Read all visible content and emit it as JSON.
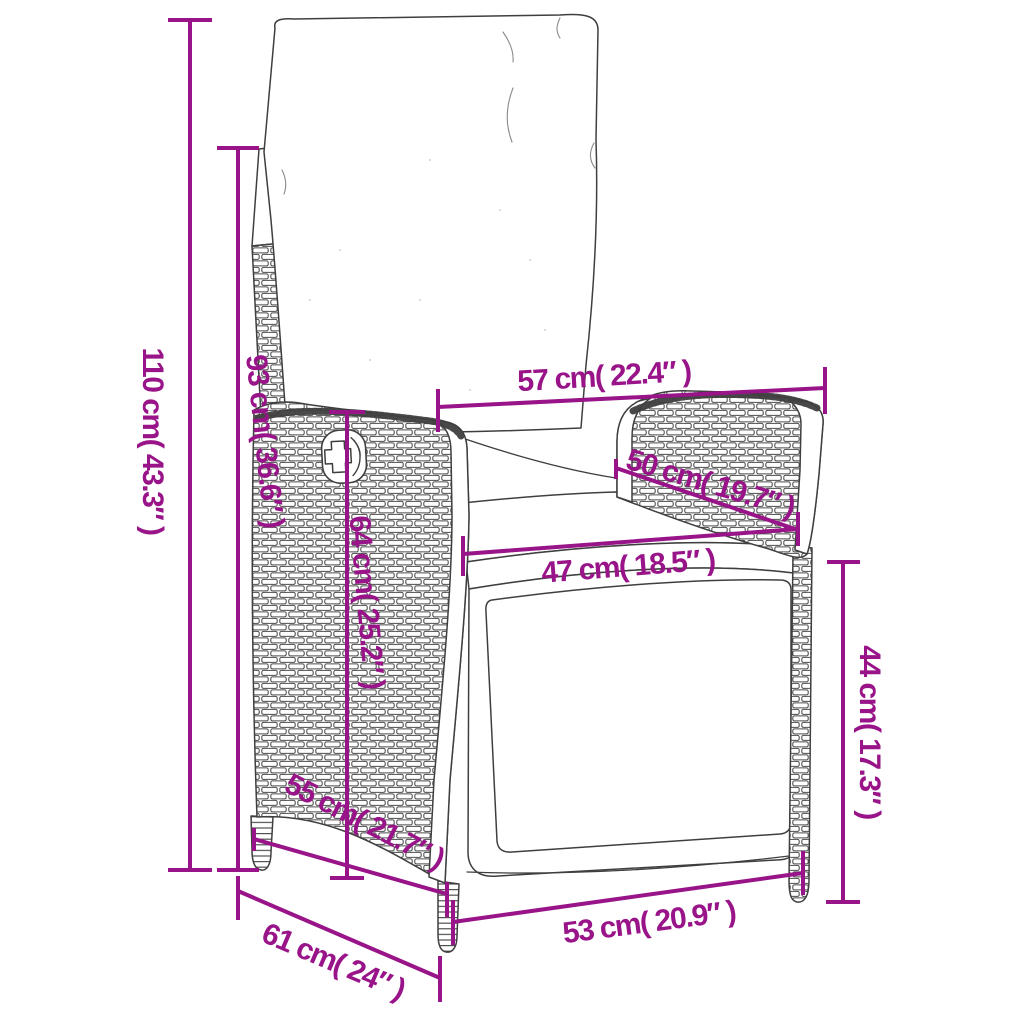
{
  "meta": {
    "subject": "Reclining rattan garden chair with cushions",
    "diagram_type": "product dimension drawing",
    "units": "cm / inches"
  },
  "colors": {
    "dimension_accent": "#981488",
    "line_art": "#3f3f3f",
    "background": "#ffffff"
  },
  "dimensions": [
    {
      "name": "total height",
      "cm": 110,
      "inches": 43.3,
      "label": "110 cm( 43.3″ )"
    },
    {
      "name": "backrest height",
      "cm": 93,
      "inches": 36.6,
      "label": "93 cm( 36.6″ )"
    },
    {
      "name": "width at armrests",
      "cm": 57,
      "inches": 22.4,
      "label": "57 cm( 22.4″ )"
    },
    {
      "name": "armrest length",
      "cm": 50,
      "inches": 19.7,
      "label": "50 cm( 19.7″ )"
    },
    {
      "name": "seat width",
      "cm": 47,
      "inches": 18.5,
      "label": "47 cm( 18.5″ )"
    },
    {
      "name": "side panel height",
      "cm": 64,
      "inches": 25.2,
      "label": "64 cm( 25.2″ )"
    },
    {
      "name": "armrest height",
      "cm": 44,
      "inches": 17.3,
      "label": "44 cm( 17.3″ )"
    },
    {
      "name": "seat depth",
      "cm": 55,
      "inches": 21.7,
      "label": "55 cm( 21.7″ )"
    },
    {
      "name": "front base width",
      "cm": 53,
      "inches": 20.9,
      "label": "53 cm( 20.9″ )"
    },
    {
      "name": "overall depth",
      "cm": 61,
      "inches": 24,
      "label": "61 cm( 24″ )"
    }
  ]
}
